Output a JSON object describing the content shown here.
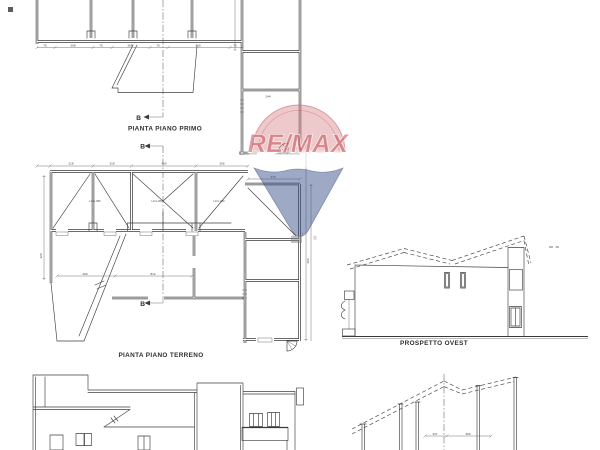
{
  "labels": {
    "plan_first": "PIANTA PIANO PRIMO",
    "plan_ground": "PIANTA PIANO TERRENO",
    "elevation_west": "PROSPETTO OVEST"
  },
  "section_marker": "B",
  "annotations": {
    "room_height": "H=m.280"
  },
  "watermark": {
    "brand": "RE/MAX",
    "registered": "®",
    "red": "#c5525e",
    "blue": "#33497f"
  },
  "dims": {
    "first_floor_bottom": [
      "75",
      "268",
      "75",
      "268",
      "75",
      "400",
      "75"
    ],
    "first_floor_right": [
      "244"
    ],
    "ground_top": [
      "218",
      "318",
      "400",
      "265"
    ],
    "ground_mid": [
      "400",
      "812"
    ],
    "ground_left": [
      "420"
    ],
    "wing_top": [
      "379"
    ],
    "wing_right": [
      "393"
    ],
    "section": [
      "337",
      "360"
    ]
  },
  "colors": {
    "ink": "#3d3d3d",
    "paper": "#ffffff"
  }
}
